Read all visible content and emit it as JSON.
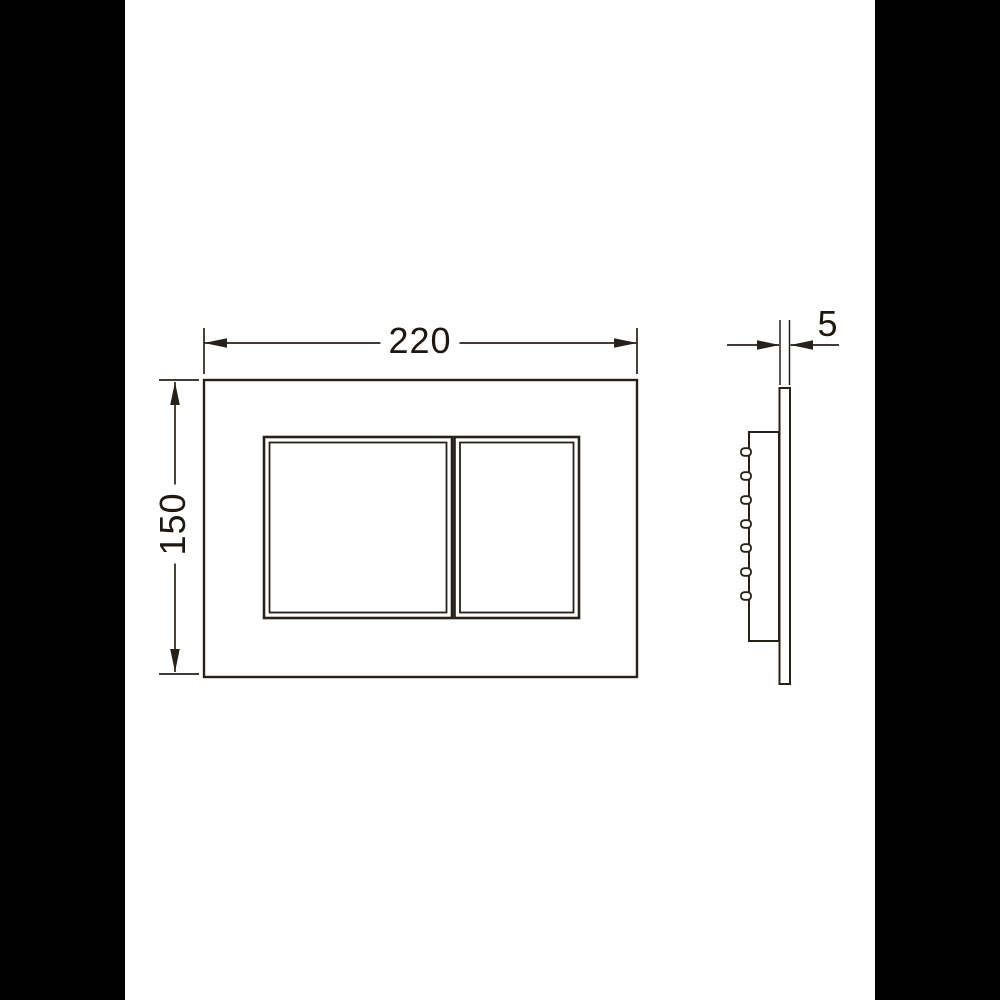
{
  "page": {
    "background_color": "#ffffff",
    "pillar_color": "#000000",
    "line_color": "#27211b",
    "text_color": "#1d1813"
  },
  "drawing": {
    "front_view": {
      "width_label": "220",
      "height_label": "150"
    },
    "side_view": {
      "thickness_label": "5",
      "clip_count": 7
    }
  }
}
